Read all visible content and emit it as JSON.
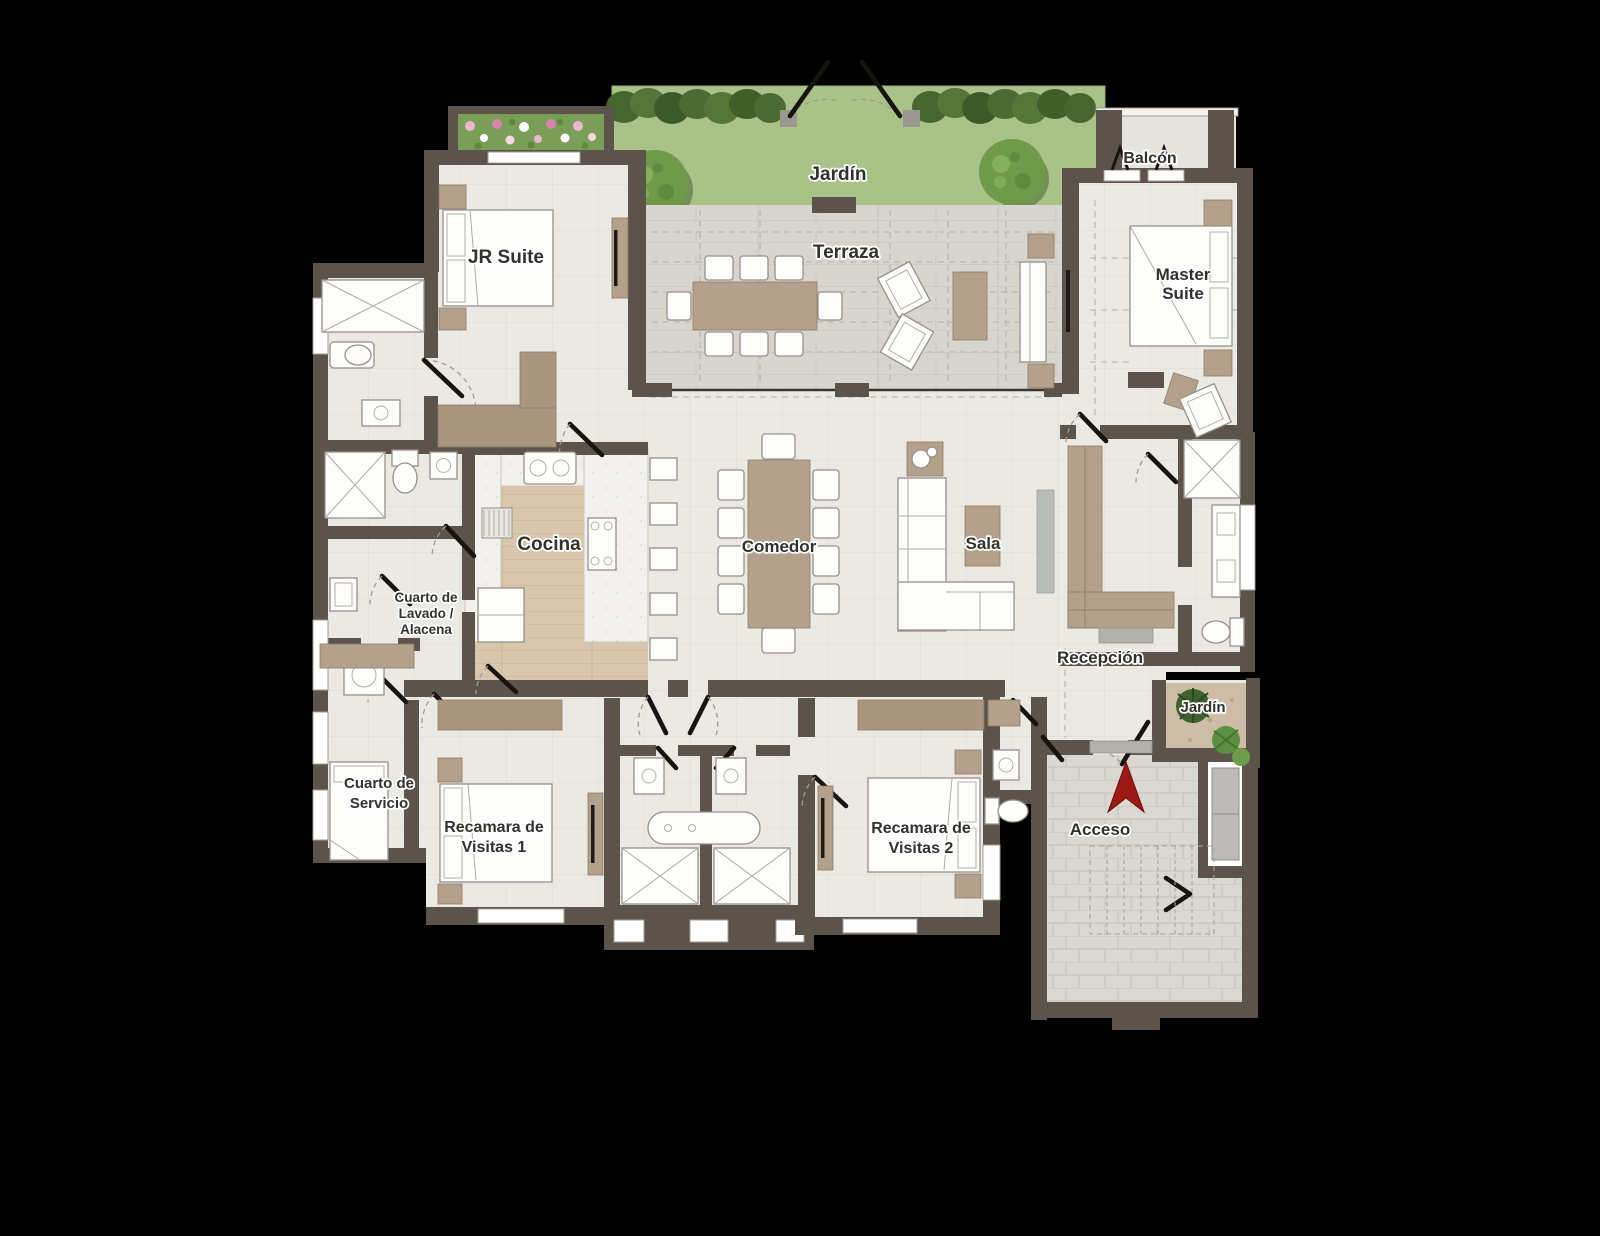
{
  "app": {
    "type": "architectural-floor-plan",
    "background": "#000000"
  },
  "rooms": {
    "jardin_top": {
      "label": "Jardín"
    },
    "terraza": {
      "label": "Terraza"
    },
    "balcon": {
      "label": "Balcón"
    },
    "jr_suite": {
      "label": "JR Suite"
    },
    "master_suite": {
      "label_line1": "Master",
      "label_line2": "Suite"
    },
    "cocina": {
      "label": "Cocina"
    },
    "comedor": {
      "label": "Comedor"
    },
    "sala": {
      "label": "Sala"
    },
    "lavado": {
      "label_line1": "Cuarto de",
      "label_line2": "Lavado /",
      "label_line3": "Alacena"
    },
    "servicio": {
      "label_line1": "Cuarto de",
      "label_line2": "Servicio"
    },
    "recamara_visitas_1": {
      "label_line1": "Recamara de",
      "label_line2": "Visitas 1"
    },
    "recamara_visitas_2": {
      "label_line1": "Recamara de",
      "label_line2": "Visitas 2"
    },
    "recepcion": {
      "label": "Recepción"
    },
    "jardin_small": {
      "label": "Jardín"
    },
    "acceso": {
      "label": "Acceso"
    }
  },
  "icons": {
    "acceso_arrow": "north-entry-arrow"
  },
  "colors": {
    "background": "#000000",
    "wall": "#5c534a",
    "floor": "#ebe9e4",
    "terrace_floor": "#d8d5cf",
    "wood_floor": "#d8c7ad",
    "wood_furniture": "#b3a18c",
    "marble": "#f2f1ed",
    "grass": "#a9c287",
    "hedge": "#4c6a36",
    "dirt": "#cdbda7",
    "white_furniture": "#fdfdfb",
    "access_arrow_red": "#9c1a14",
    "label_text": "#33312e"
  }
}
